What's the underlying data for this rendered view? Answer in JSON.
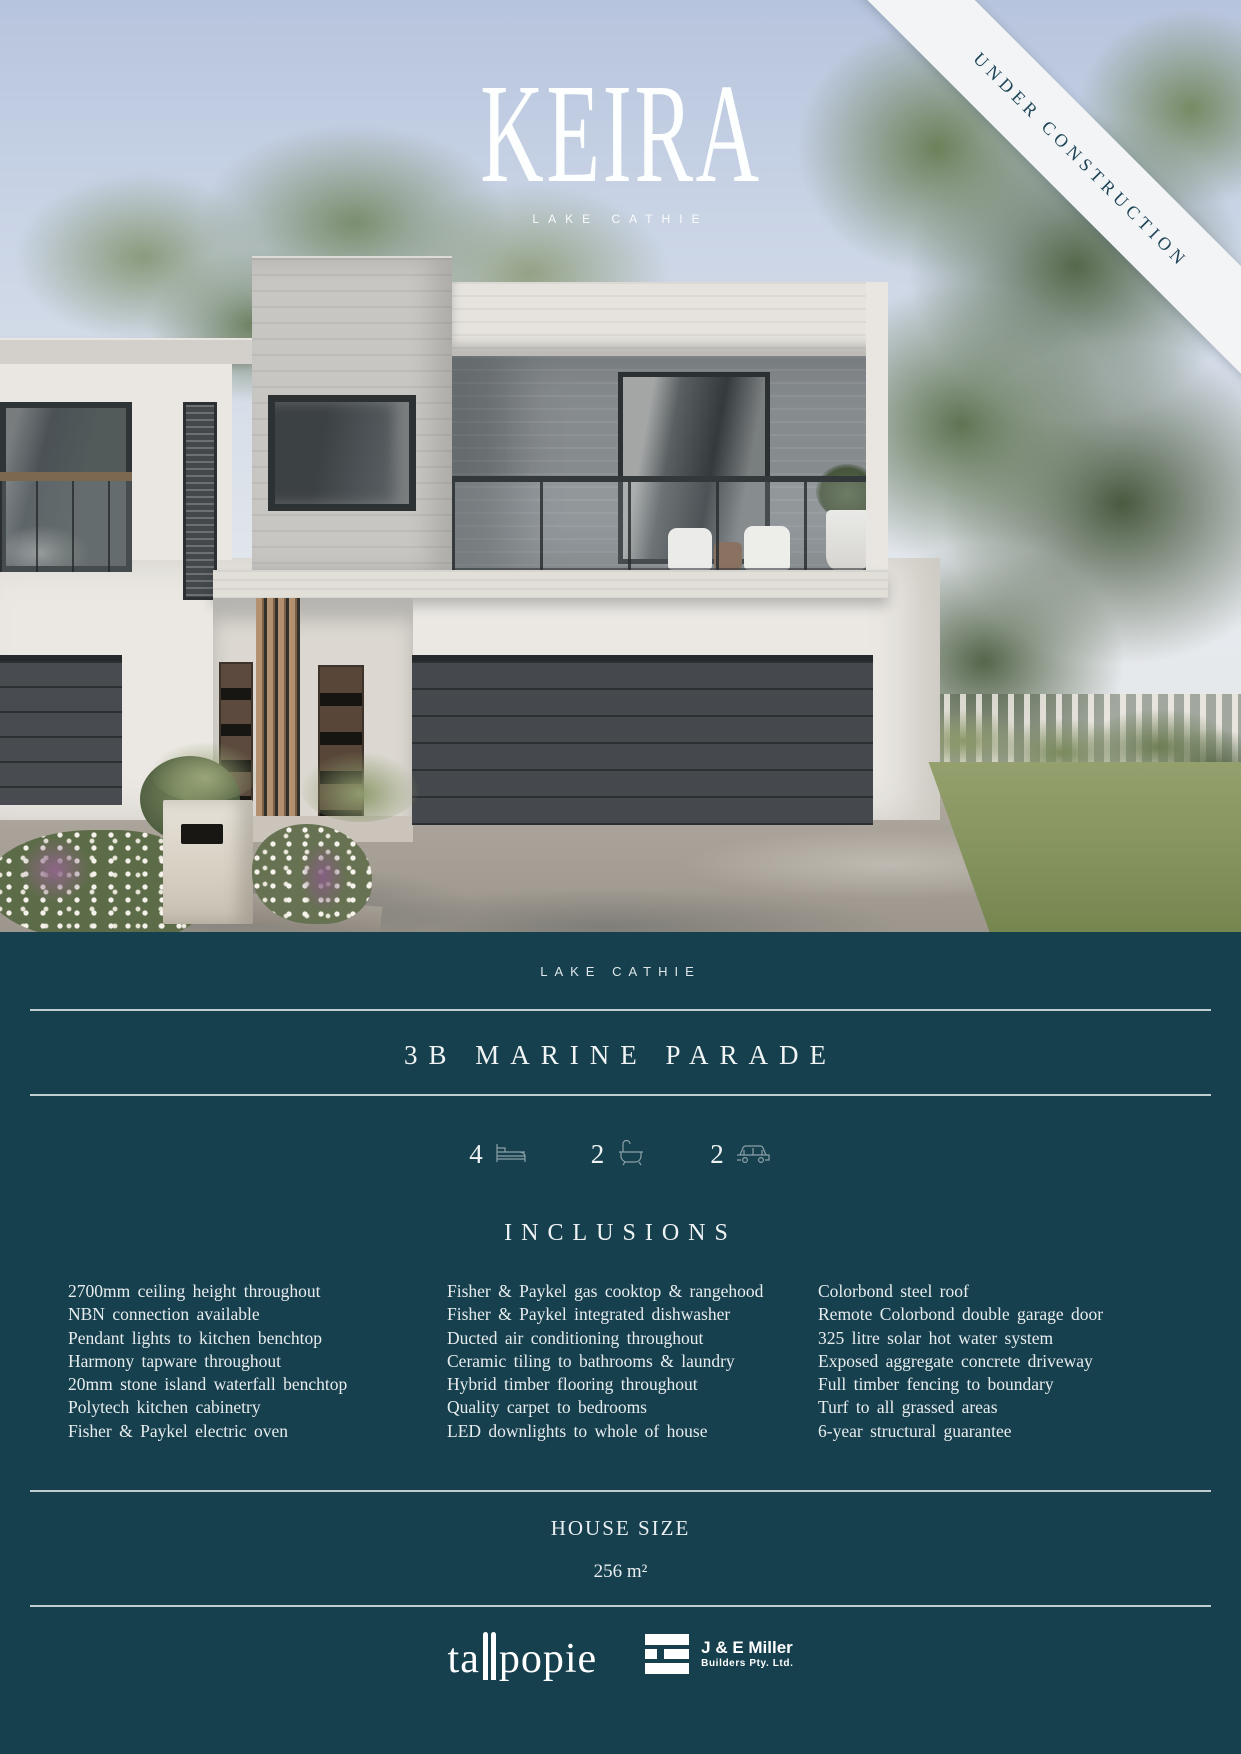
{
  "hero": {
    "title": "KEIRA",
    "subtitle": "LAKE CATHIE",
    "ribbon": "UNDER CONSTRUCTION"
  },
  "info": {
    "location": "LAKE CATHIE",
    "address": "3B MARINE PARADE",
    "stats": [
      {
        "value": "4",
        "icon": "bed-icon"
      },
      {
        "value": "2",
        "icon": "bath-icon"
      },
      {
        "value": "2",
        "icon": "car-icon"
      }
    ],
    "inclusions": {
      "heading": "INCLUSIONS",
      "columns": [
        {
          "items": [
            "2700mm ceiling height throughout",
            "NBN connection available",
            "Pendant lights to kitchen benchtop",
            "Harmony tapware throughout",
            "20mm stone island waterfall benchtop",
            "Polytech kitchen cabinetry",
            "Fisher & Paykel electric oven"
          ]
        },
        {
          "items": [
            "Fisher & Paykel gas cooktop & rangehood",
            "Fisher & Paykel integrated dishwasher",
            "Ducted air conditioning throughout",
            "Ceramic tiling to bathrooms & laundry",
            "Hybrid timber flooring throughout",
            "Quality carpet to bedrooms",
            "LED downlights to whole of house"
          ]
        },
        {
          "items": [
            "Colorbond steel roof",
            "Remote Colorbond double garage door",
            "325 litre solar hot water system",
            "Exposed aggregate concrete driveway",
            "Full timber fencing to boundary",
            "Turf to all grassed areas",
            "6-year structural guarantee"
          ]
        }
      ]
    },
    "house_size": {
      "heading": "HOUSE SIZE",
      "value": "256 m²"
    },
    "footer": {
      "tallpopie": {
        "prefix": "ta",
        "suffix": "popie"
      },
      "builder": {
        "name": "J & E Miller",
        "subtitle": "Builders Pty. Ltd."
      }
    }
  },
  "colors": {
    "background_teal": "#17404E",
    "ribbon_bg": "#F2F4F6",
    "ribbon_text": "#1E4557"
  }
}
